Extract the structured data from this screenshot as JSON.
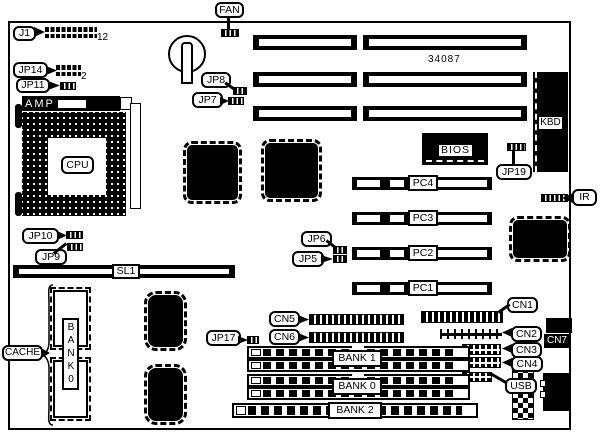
{
  "diagram": {
    "type": "motherboard-jumper-connector-location-diagram",
    "part_number": "34087",
    "pin_annotations": {
      "j1_pins": "12",
      "jp14_pins": "2"
    },
    "callouts": {
      "j1": "J1",
      "fan": "FAN",
      "jp14": "JP14",
      "jp11": "JP11",
      "jp8": "JP8",
      "jp7": "JP7",
      "jp19": "JP19",
      "ir": "IR",
      "jp10": "JP10",
      "jp9": "JP9",
      "jp6": "JP6",
      "jp5": "JP5",
      "cache": "CACHE",
      "jp17": "JP17",
      "cn5": "CN5",
      "cn6": "CN6",
      "cn1": "CN1",
      "cn2": "CN2",
      "cn3": "CN3",
      "cn4": "CN4",
      "usb": "USB",
      "cpu": "CPU"
    },
    "components": {
      "amp": "AMP",
      "kbd": "KBD",
      "bios": "BIOS",
      "sl1": "SL1",
      "cn7": "CN7",
      "cache_bank_vertical": "BANK0",
      "pc4": "PC4",
      "pc3": "PC3",
      "pc2": "PC2",
      "pc1": "PC1",
      "bank1": "BANK 1",
      "bank0": "BANK 0",
      "bank2": "BANK 2"
    },
    "colors": {
      "foreground": "#000000",
      "background": "#ffffff"
    }
  }
}
